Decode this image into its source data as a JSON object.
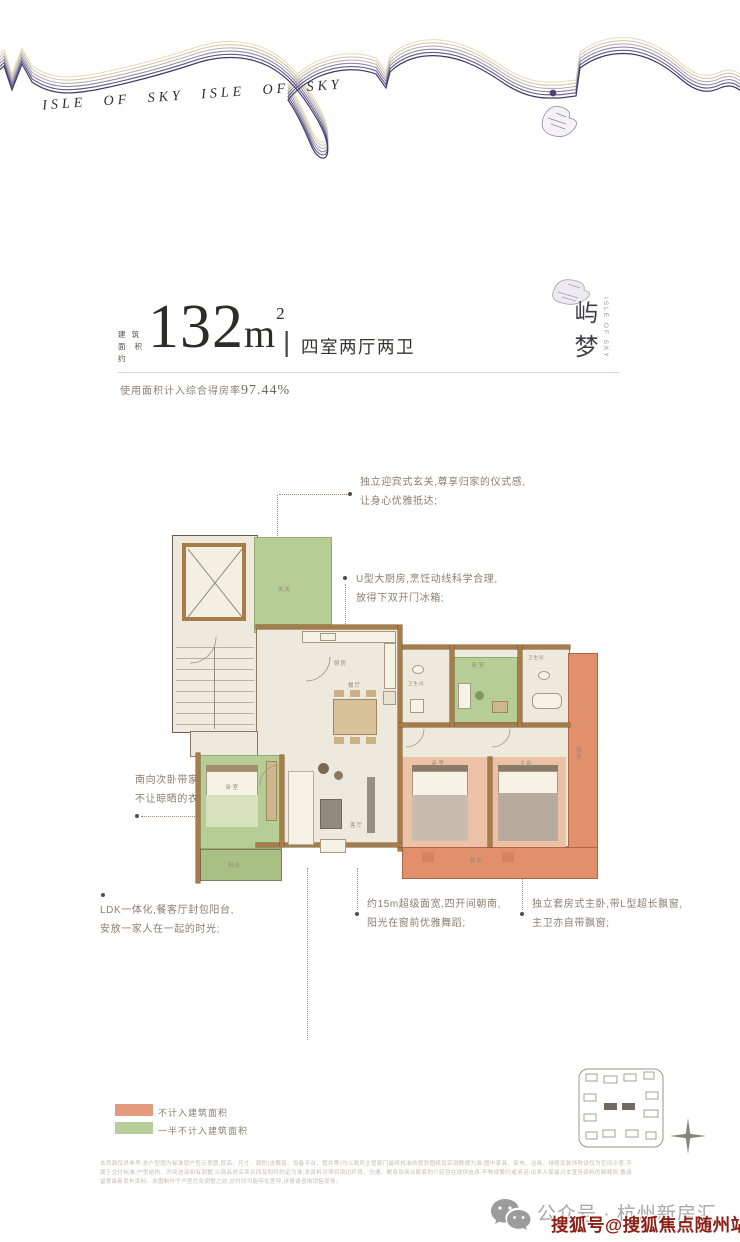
{
  "wave": {
    "script_text": "ISLE OF SKY   ISLE OF SKY"
  },
  "brand": {
    "name_vertical": "屿梦",
    "name_sub": "ISLE OF SKY"
  },
  "title": {
    "prefix_line1": "建 筑",
    "prefix_line2": "面积约",
    "area_number": "132",
    "area_unit": "m",
    "area_exponent": "2",
    "separator": "|",
    "rooms": "四室两厅两卫",
    "efficiency_label": "使用面积计入综合得房率",
    "efficiency_value": "97.44%"
  },
  "annotations": {
    "entry": {
      "line1": "独立迎宾式玄关,尊享归家的仪式感,",
      "line2": "让身心优雅抵达;"
    },
    "kitchen": {
      "line1": "U型大厨房,烹饪动线科学合理,",
      "line2": "放得下双开门冰箱;"
    },
    "north_bedroom": {
      "line1": "南向次卧带家政阳台,",
      "line2": "不让晾晒的衣物遮挡风景的视野。"
    },
    "ldk": {
      "line1": "LDK一体化,餐客厅封包阳台,",
      "line2": "安放一家人在一起的时光;"
    },
    "width": {
      "line1": "约15m超级面宽,四开间朝南,",
      "line2": "阳光在窗前优雅舞蹈;"
    },
    "master": {
      "line1": "独立套房式主卧,带L型超长飘窗,",
      "line2": "主卫亦自带飘窗;"
    }
  },
  "plan": {
    "labels": {
      "entry": "玄关",
      "kitchen": "厨房",
      "dining": "餐厅",
      "living": "客厅",
      "bedroom_left": "卧室",
      "laundry_balcony": "阳台",
      "bath1": "卫生间",
      "bedroom_top": "卧室",
      "bath2": "卫生间",
      "bedroom_mid": "卧室",
      "master": "主卧",
      "bay_right": "飘窗",
      "bay_bottom": "飘窗"
    }
  },
  "legend": {
    "item1": {
      "label": "不计入建筑面积",
      "color": "#e49a7d"
    },
    "item2": {
      "label": "一半不计入建筑面积",
      "color": "#b9cf9b"
    }
  },
  "disclaimer": "本页面仅供参考:本户型图为标准层户型示意图,层高、尺寸、面积(含飘窗、设备平台、管井等)均以政府主管部门最终核准的规划图纸及实测数据为准;图中家具、家电、洁具、绿植及装饰陈设仅为空间示意,不属于交付标准;户型结构、开间进深如有调整,以商品房买卖合同及附件约定为准;本资料对项目周边环境、交通、教育及商业配套的介绍旨在提供信息,不构成要约或承诺;出卖人保留对本宣传资料的解释权,敬请留意最新发布资料。本图制作于户型优化调整之前,交付时可能存在差异,详情请咨询销售现场。",
  "footer": {
    "account": "公众号 · 杭州新房汇",
    "watermark": "搜狐号@搜狐焦点随州站"
  },
  "colors": {
    "salmon_balcony": "#e2906c",
    "salmon_room": "#edc1a6",
    "green_half": "#b6cd95",
    "wall_brown": "#a87c49",
    "floor_cream": "#ede9dc",
    "watermark_red": "#8c2016",
    "wave_purple": "#3f3a66",
    "wave_beige": "#e4ddc0"
  }
}
